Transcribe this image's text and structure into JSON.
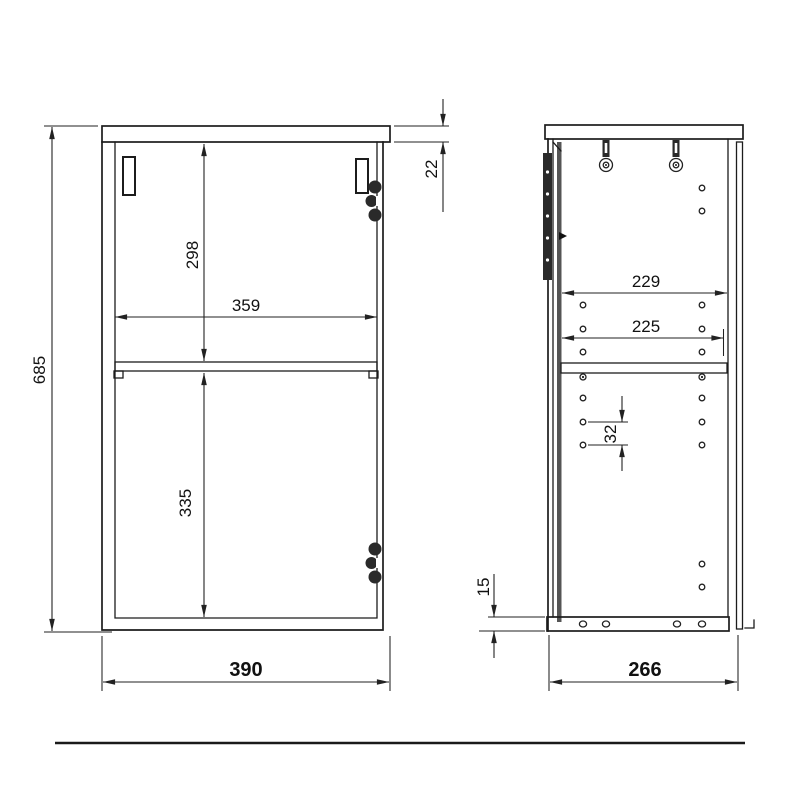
{
  "canvas": {
    "background": "#ffffff",
    "line_color": "#1c1c1c",
    "dim_color": "#222222",
    "door_edge_color": "#555555"
  },
  "front_view": {
    "name": "cabinet front elevation",
    "dims": {
      "overall_height": "685",
      "overall_width": "390",
      "top_panel_thickness": "22",
      "inner_width": "359",
      "upper_compartment_height": "298",
      "lower_compartment_height": "335"
    }
  },
  "side_view": {
    "name": "cabinet side section",
    "dims": {
      "overall_depth": "266",
      "inner_depth": "229",
      "shelf_depth": "225",
      "hole_pitch": "32",
      "bottom_panel_thickness": "15"
    }
  },
  "hardware": {
    "hinge": "concealed hinge",
    "wall_bracket": "wall hanging bracket",
    "shelf_holes": "shelf pin holes"
  }
}
